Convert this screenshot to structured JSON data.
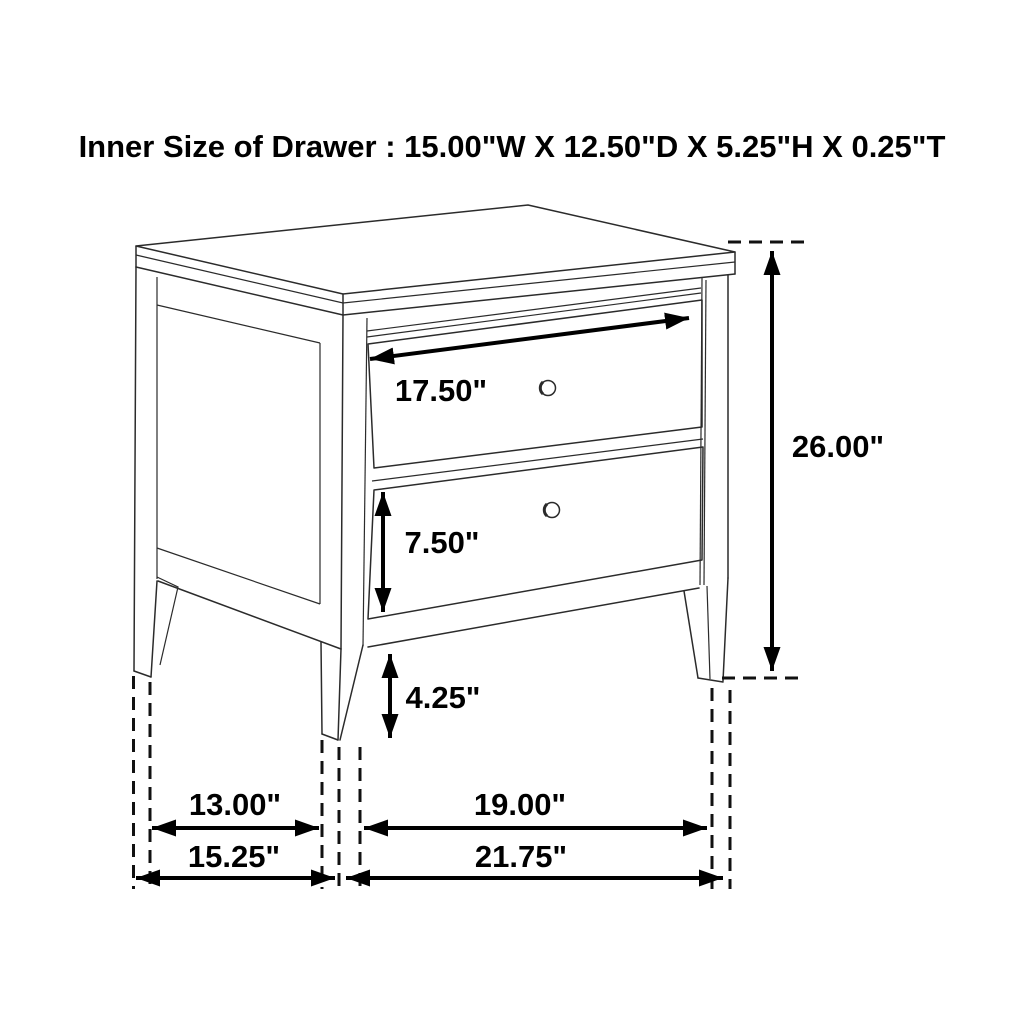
{
  "title": "Inner Size of Drawer : 15.00\"W X 12.50\"D X 5.25\"H X 0.25\"T",
  "dimensions": {
    "drawer_face_width": "17.50\"",
    "overall_height": "26.00\"",
    "lower_drawer_height": "7.50\"",
    "leg_height": "4.25\"",
    "side_leg_spacing": "13.00\"",
    "overall_depth": "15.25\"",
    "front_leg_spacing": "19.00\"",
    "overall_width": "21.75\""
  },
  "colors": {
    "background": "#ffffff",
    "line": "#2b2b2b",
    "dimension": "#000000"
  }
}
